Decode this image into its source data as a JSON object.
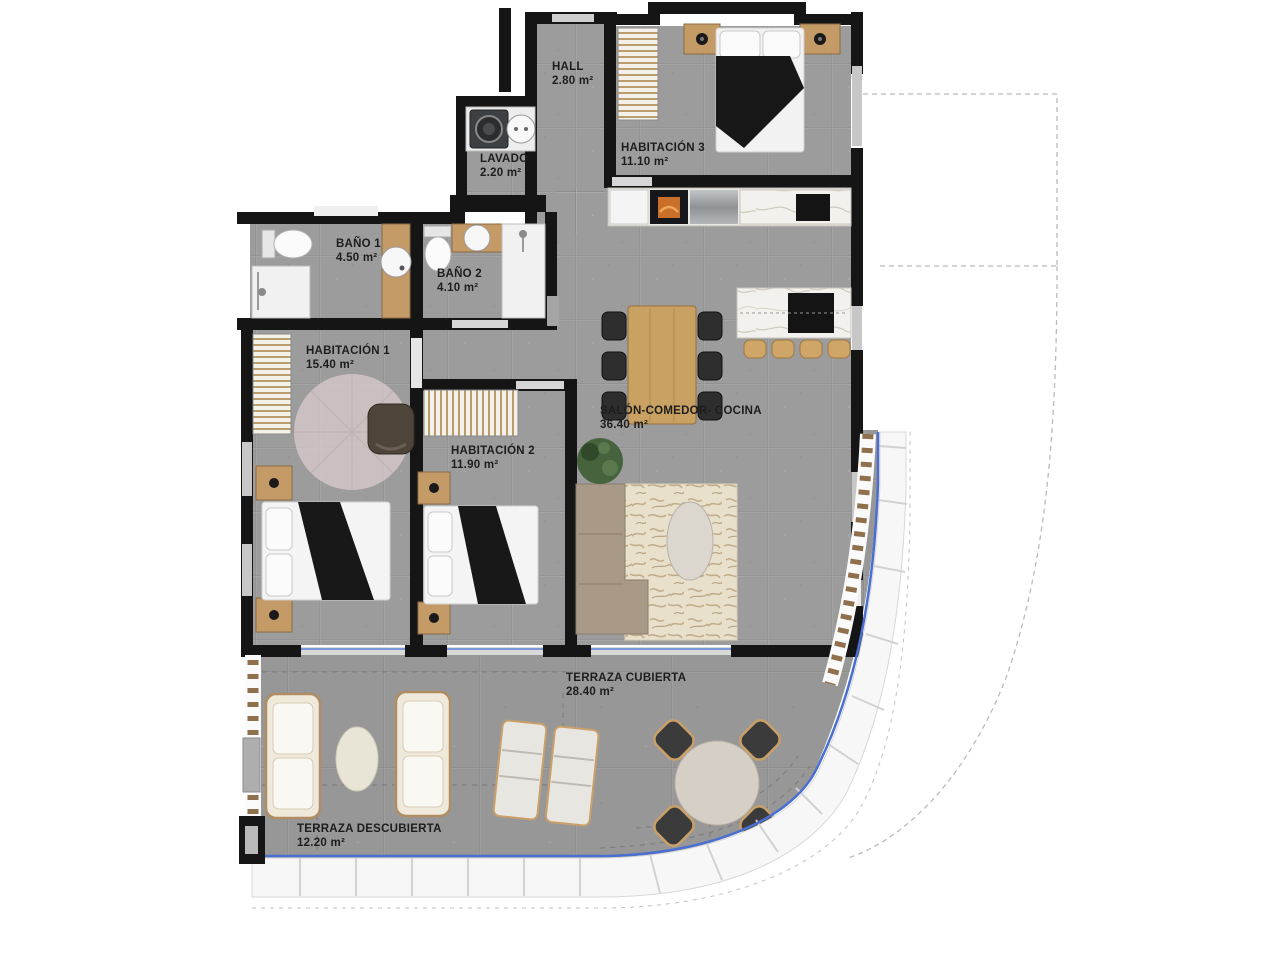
{
  "rooms": {
    "hall": {
      "name": "HALL",
      "area": "2.80 m²"
    },
    "lavado": {
      "name": "LAVADO",
      "area": "2.20 m²"
    },
    "habitacion3": {
      "name": "HABITACIÓN 3",
      "area": "11.10 m²"
    },
    "bano1": {
      "name": "BAÑO 1",
      "area": "4.50 m²"
    },
    "bano2": {
      "name": "BAÑO 2",
      "area": "4.10 m²"
    },
    "habitacion1": {
      "name": "HABITACIÓN 1",
      "area": "15.40 m²"
    },
    "habitacion2": {
      "name": "HABITACIÓN 2",
      "area": "11.90 m²"
    },
    "salon": {
      "name": "SALÓN-COMEDOR- COCINA",
      "area": "36.40 m²"
    },
    "terraza_cubierta": {
      "name": "TERRAZA CUBIERTA",
      "area": "28.40 m²"
    },
    "terraza_descubierta": {
      "name": "TERRAZA DESCUBIERTA",
      "area": "12.20 m²"
    }
  },
  "colors": {
    "wall": "#151515",
    "floor": "#9c9c9c",
    "glass_balustrade": "#4a6fd0",
    "wood": "#c49a66",
    "marble": "#f3f1ed",
    "duvet": "#181818",
    "sofa": "#a89a86",
    "rug": "#e8dfcc",
    "plant": "#47633e",
    "slat_screen": "#8f6f4c"
  }
}
